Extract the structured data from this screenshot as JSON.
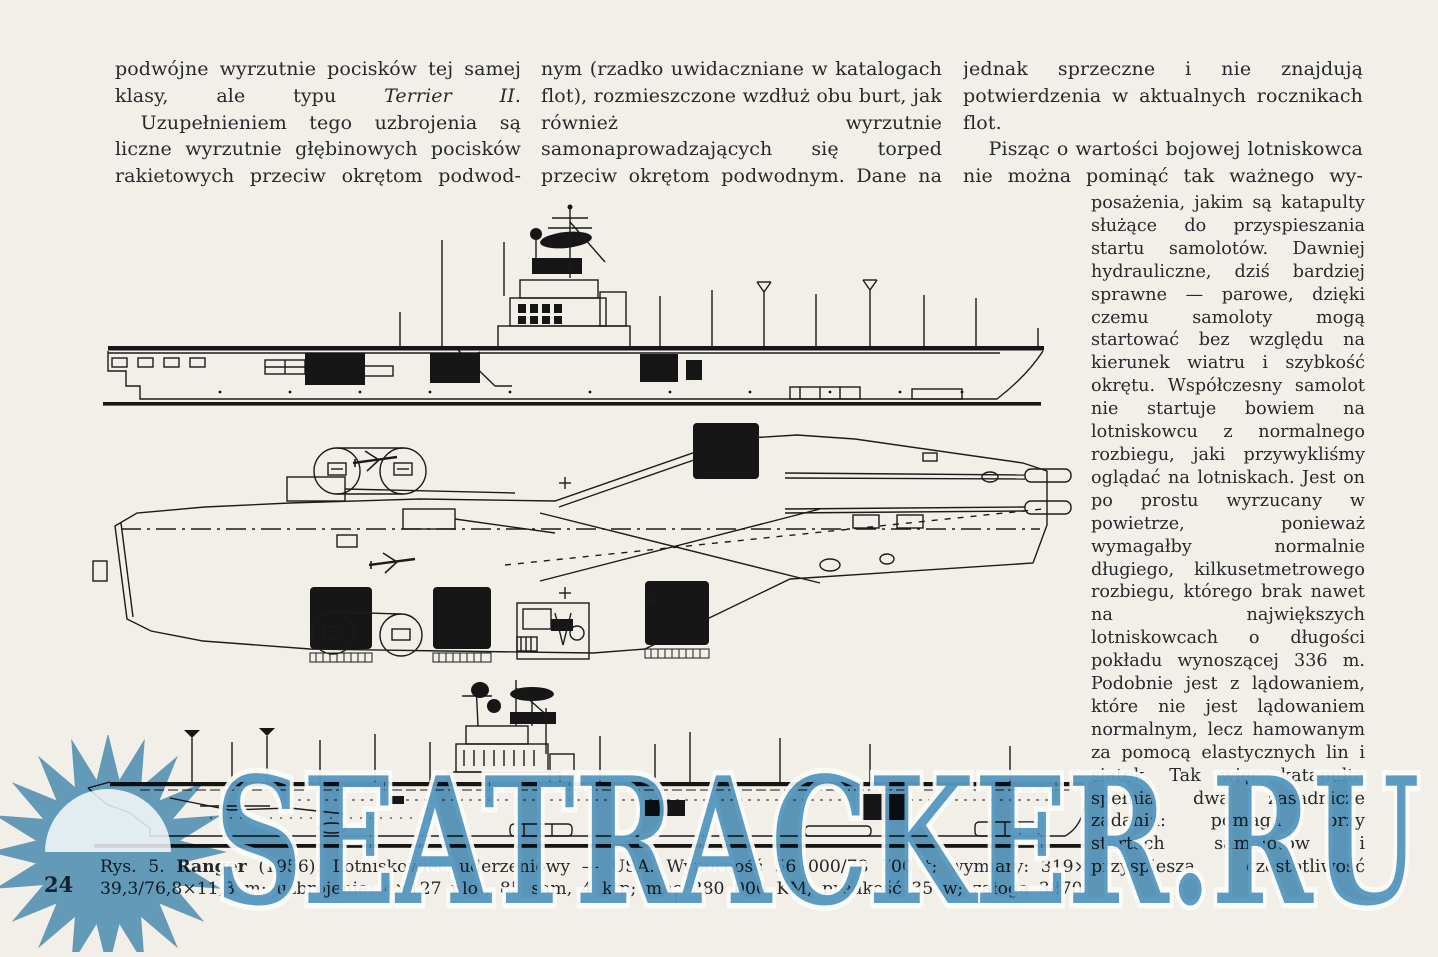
{
  "page": {
    "number": "24",
    "paper_color": "#f2efe8",
    "ink_color": "#26292c"
  },
  "article": {
    "column1": {
      "p1_before_italic": "podwójne wyrzutnie pocisków tej samej klasy, ale typu ",
      "p1_italic": "Terrier II",
      "p1_after_italic": ".",
      "p2": "Uzupełnieniem tego uzbrojenia są liczne wyrzutnie głębinowych pocisków rakietowych przeciw okrętom podwod-"
    },
    "column2": {
      "p1": "nym (rzadko uwidaczniane w katalogach flot), rozmieszczone wzdłuż obu burt, jak również wyrzutnie samonaprowadzających się torped przeciw okrętom podwodnym. Dane na ten temat są"
    },
    "column3": {
      "p1": "jednak sprzeczne i nie znajdują potwierdzenia w aktualnych rocznikach flot.",
      "p2": "Pisząc o wartości bojowej lotniskowca nie można pominąć tak ważnego wy-",
      "p3": "posażenia, jakim są katapulty służące do przyspieszania startu samolotów. Dawniej hydrauliczne, dziś bardziej sprawne — parowe, dzięki czemu samoloty mogą startować bez względu na kierunek wiatru i szybkość okrętu. Współczesny samolot nie startuje bowiem na lotniskowcu z normalnego rozbiegu, jaki przywykliśmy oglądać na lotniskach. Jest on po prostu wyrzucany w powietrze, ponieważ wymagałby normalnie długiego, kilkusetmetrowego rozbiegu, którego brak nawet na największych lotniskowcach o długości pokładu wynoszącej 336 m. Podobnie jest z lądowaniem, które nie jest lądowaniem normalnym, lecz hamowanym za pomocą elastycznych lin i siatek. Tak więc katapulta spełnia dwa zasadnicze zadania: pomaga przy startach samolotów i przyspiesza częstotliwość"
    }
  },
  "figure": {
    "caption_prefix": "Rys. 5. ",
    "caption_ship_name": "Ranger",
    "caption_line1_rest": " (1956). Lotniskowiec uderzeniowy — USA. Wyporność 56 000/78 700 t; wymiary: 319×",
    "caption_line2": "39,3/76,8×11,3 m; uzbrojenie: 4×127 plot, 85 sam, 4 ktp; moc 280 000 KM; prędkość 35 w; załoga 3870.",
    "views": [
      "side profile",
      "flight deck plan",
      "outboard profile"
    ]
  },
  "watermark": {
    "text": "SEATRACKER.RU",
    "color": "#4e95c3"
  }
}
